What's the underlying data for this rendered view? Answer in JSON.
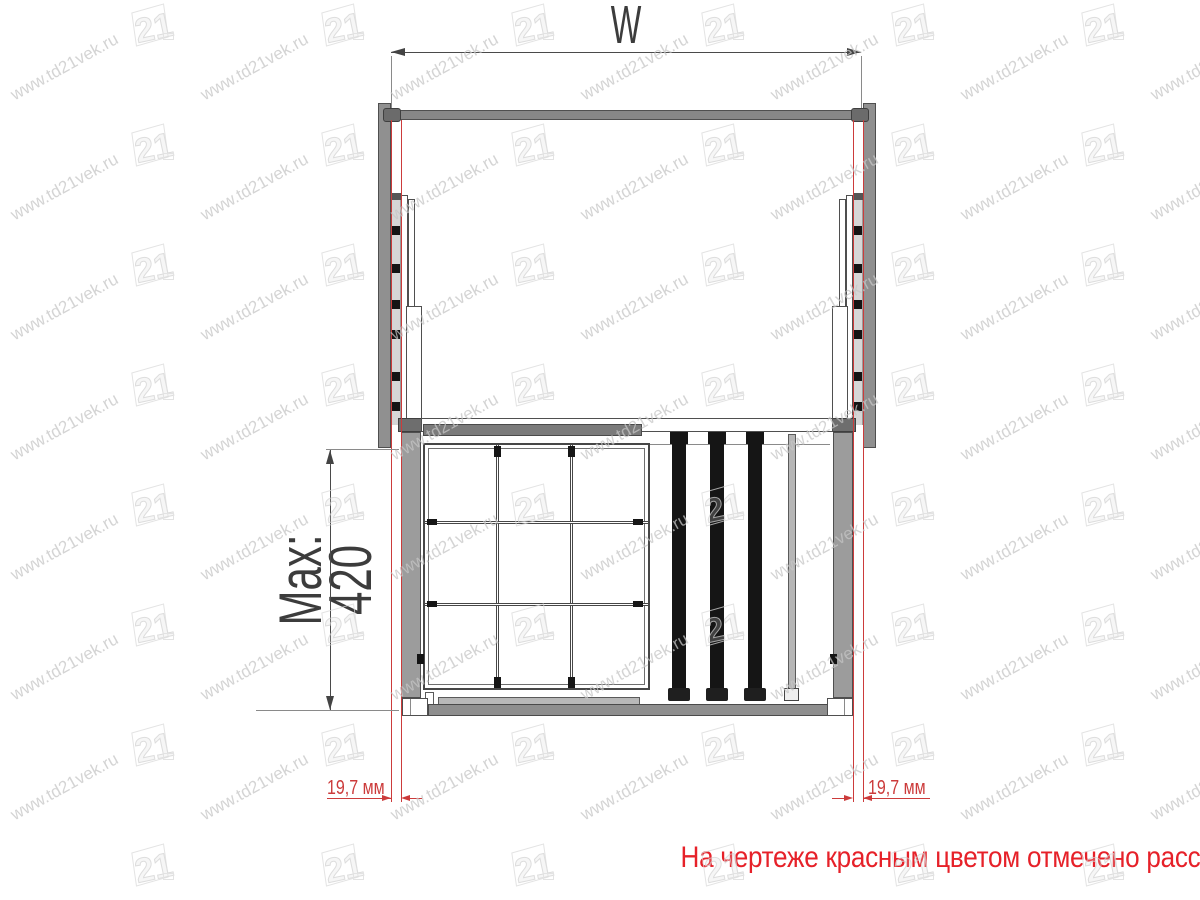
{
  "watermark": {
    "url_text": "www.td21vek.ru",
    "logo_text": "21"
  },
  "drawing": {
    "width_dimension_label": "W",
    "depth_dimension_label": "Max: 420",
    "left_gap_dimension_label": "19,7 мм",
    "right_gap_dimension_label": "19,7 мм"
  },
  "caption": {
    "text": "На чертеже красным цветом отмечено расстояние  от стенки шкафа до боковины изделия."
  },
  "colors": {
    "dimension_red": "#cc3b3b",
    "caption_red": "#e62129",
    "wall_gray": "#909090",
    "outline_gray": "#4a4a4a",
    "watermark_gray": "#c6c6c6",
    "black_rail": "#151515"
  }
}
